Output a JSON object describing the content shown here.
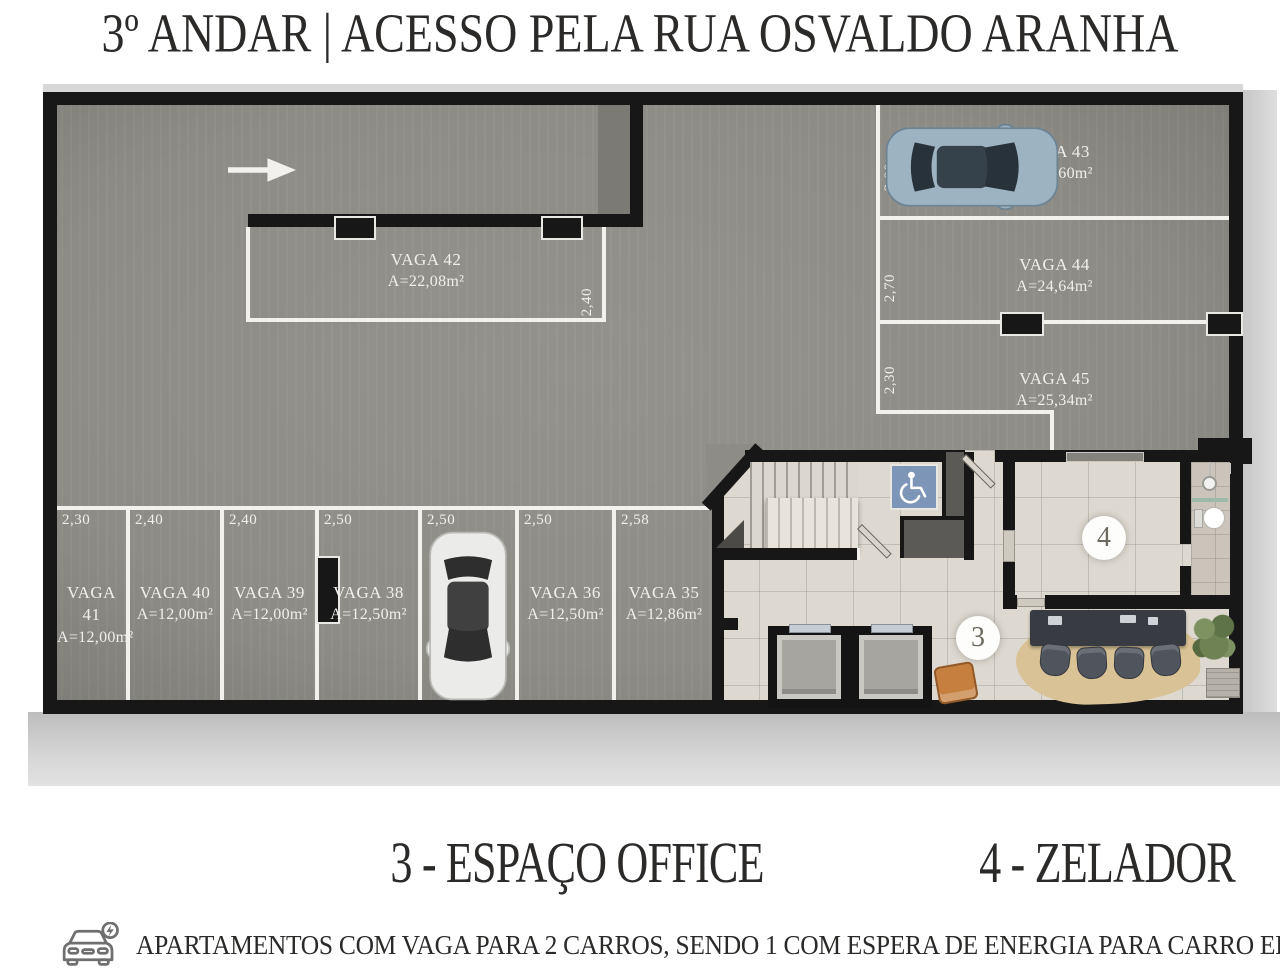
{
  "title": "3º ANDAR | ACESSO PELA RUA OSVALDO ARANHA",
  "plan": {
    "direction_arrow": "right",
    "vaga42": {
      "name": "VAGA 42",
      "area": "A=22,08m²",
      "width_dim": "2,40"
    },
    "right_stalls": [
      {
        "name": "VAGA 43",
        "area": "A=27,60m²",
        "width_dim": "3,00",
        "has_car": true
      },
      {
        "name": "VAGA 44",
        "area": "A=24,64m²",
        "width_dim": "2,70",
        "has_car": false
      },
      {
        "name": "VAGA 45",
        "area": "A=25,34m²",
        "width_dim": "2,30",
        "has_car": false
      }
    ],
    "bottom_stalls": [
      {
        "name": "VAGA 41",
        "area": "A=12,00m²",
        "width_dim": "2,30",
        "has_car": false
      },
      {
        "name": "VAGA 40",
        "area": "A=12,00m²",
        "width_dim": "2,40",
        "has_car": false
      },
      {
        "name": "VAGA 39",
        "area": "A=12,00m²",
        "width_dim": "2,40",
        "has_car": false
      },
      {
        "name": "VAGA 38",
        "area": "A=12,50m²",
        "width_dim": "2,50",
        "has_car": false
      },
      {
        "name": "VAGA 37",
        "area": "A=12,50m²",
        "width_dim": "2,50",
        "has_car": true
      },
      {
        "name": "VAGA 36",
        "area": "A=12,50m²",
        "width_dim": "2,50",
        "has_car": false
      },
      {
        "name": "VAGA 35",
        "area": "A=12,86m²",
        "width_dim": "2,58",
        "has_car": false
      }
    ],
    "markers": {
      "office": "3",
      "zelador": "4"
    },
    "icons": [
      "wheelchair-icon",
      "direction-arrow-icon",
      "car-top-view-blue",
      "car-top-view-white"
    ]
  },
  "legend": [
    {
      "label": "3 - ESPAÇO OFFICE"
    },
    {
      "label": "4 - ZELADOR"
    }
  ],
  "note": {
    "icon": "electric-car-icon",
    "text": "APARTAMENTOS COM VAGA PARA 2 CARROS, SENDO 1 COM ESPERA DE ENERGIA PARA CARRO ELÉTRICO."
  },
  "colors": {
    "wall": "#171717",
    "garage_floor": "#8e8c86",
    "tile_floor": "#ded9d0",
    "parking_line": "#f2f1ed",
    "sign_blue": "#7d95b6",
    "car_blue": "#9db3c2",
    "car_white": "#ebebe9",
    "chair_orange": "#c57f3f",
    "text_dark": "#2b2a28",
    "floor_text": "#f0efeb",
    "dark_fixture": "#5b5a56",
    "rug": "#d9c296",
    "desk": "#383c42",
    "plant": "#6e8253"
  }
}
